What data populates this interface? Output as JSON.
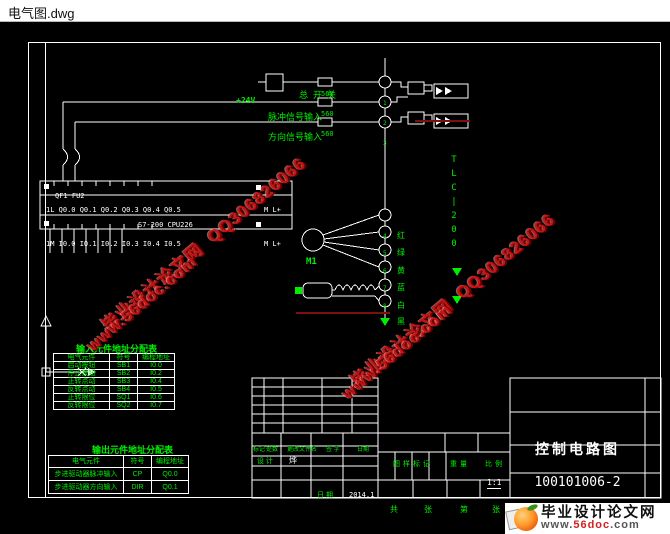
{
  "window": {
    "title": "电气图.dwg"
  },
  "colors": {
    "line_green": "#00ef00",
    "draw_white": "#ffffff",
    "watermark_red": "#c41414",
    "logo_red": "#d42020",
    "canvas": "#000000"
  },
  "signals": {
    "power": "+24V",
    "switch_label": "总开关",
    "resistor": "560",
    "pulse_label": "脉冲信号输入",
    "direction_label": "方向信号输入",
    "breaker_label": "QF1 FU2"
  },
  "plc": {
    "top_terminals": "1L Q0.0 Q0.1 Q0.2 Q0.3 Q0.4 Q0.5",
    "top_right": "M L+",
    "model": "S7-200 CPU226",
    "bottom_terminals": "1M I0.0 I0.1 I0.2 I0.3 I0.4 I0.5",
    "bottom_right": "M L+"
  },
  "driver": {
    "label_chars": [
      "T",
      "L",
      "C",
      "|",
      "2",
      "0",
      "0"
    ],
    "motor_label": "M1",
    "terminals": [
      "1",
      "2",
      "3",
      "4",
      "5",
      "6",
      "7",
      "8",
      "9"
    ],
    "wire_tags": [
      "红",
      "绿",
      "黄",
      "蓝",
      "白",
      "黑"
    ]
  },
  "input_table": {
    "title": "输入元件地址分配表",
    "headers": [
      "电气元件",
      "符号",
      "编程地址"
    ],
    "rows": [
      [
        "启动按钮",
        "SB1",
        "I0.0"
      ],
      [
        "停止按钮",
        "SB2",
        "I0.2"
      ],
      [
        "正转点动",
        "SB3",
        "I0.4"
      ],
      [
        "反转点动",
        "SB4",
        "I0.5"
      ],
      [
        "正转限位",
        "SQ1",
        "I0.6"
      ],
      [
        "反转限位",
        "SQ2",
        "I0.7"
      ]
    ]
  },
  "output_table": {
    "title": "输出元件地址分配表",
    "headers": [
      "电气元件",
      "符号",
      "编程地址"
    ],
    "rows": [
      [
        "步进驱动器脉冲输入",
        "CP",
        "Q0.0"
      ],
      [
        "步进驱动器方向输入",
        "DIR",
        "Q0.1"
      ]
    ]
  },
  "title_block": {
    "rev_headers": [
      "标记",
      "处数",
      "更改文件名",
      "签 字",
      "日期"
    ],
    "design_label": "设 计",
    "designer": "烨",
    "date_label": "日 期",
    "date_value": "2014.1",
    "stamp_label": "图样标记",
    "weight_label": "重量",
    "scale_label": "比例",
    "scale_value": "1:1",
    "sheets_label": "共",
    "sheets_unit": "张",
    "page_label": "第",
    "page_unit": "张",
    "drawing_title": "控制电路图",
    "drawing_number": "100101006-2"
  },
  "watermark": {
    "site": "毕业设计论文网",
    "qq": "QQ306826066",
    "url": "www.56doc.com"
  },
  "logo": {
    "site_name": "毕业设计论文网",
    "url_prefix": "www.",
    "url_mid": "56doc",
    "url_suffix": ".com"
  }
}
